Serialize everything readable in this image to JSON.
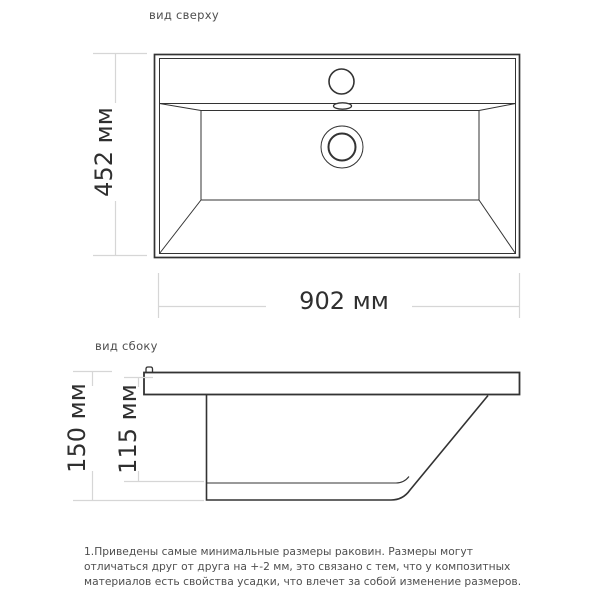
{
  "titles": {
    "top_view": "вид сверху",
    "side_view": "вид сбоку"
  },
  "dimensions": {
    "top_width": "902 мм",
    "top_depth": "452 мм",
    "side_height": "150 мм",
    "side_basin_depth": "115 мм"
  },
  "note": {
    "lines": [
      "1.Приведены самые минимальные размеры раковин. Размеры могут",
      "отличаться друг от друга на +-2 мм, это связано с тем, что у композитных",
      "материалов есть свойства усадки, что влечет за собой изменение размеров."
    ]
  },
  "colors": {
    "background": "#ffffff",
    "line": "#333333",
    "dimension": "#d6d6d6",
    "text": "#2f2f2f",
    "secondary_text": "#4f4f4f"
  }
}
